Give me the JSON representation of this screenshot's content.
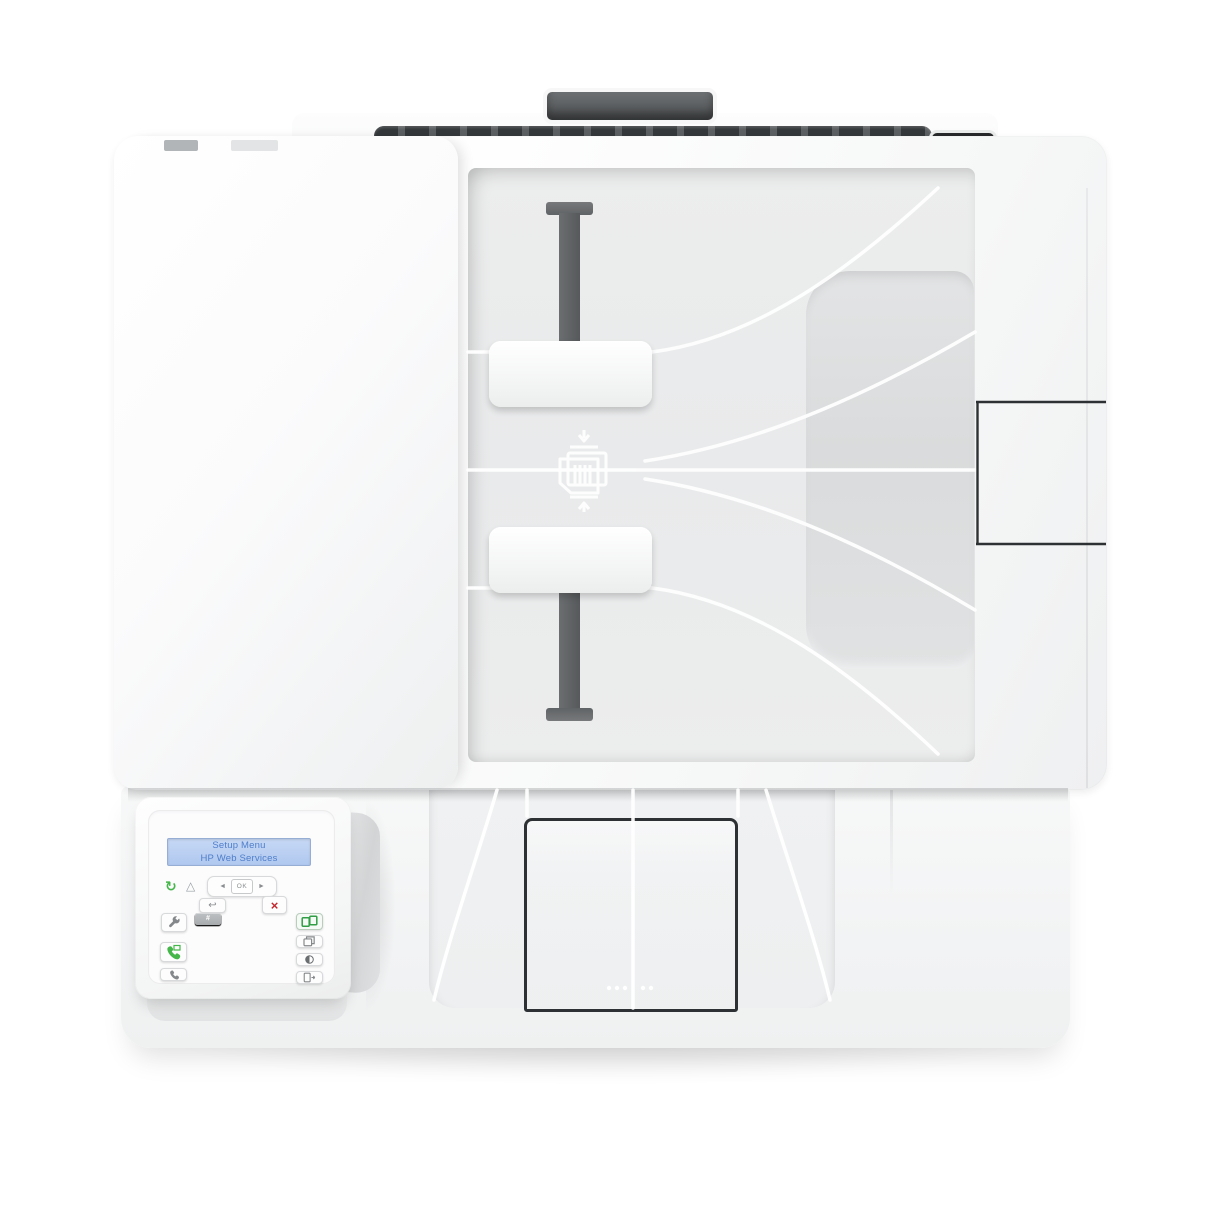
{
  "scene": {
    "description": "Top-down product photo of a white HP multifunction laser printer",
    "background_color": "#ffffff"
  },
  "printer": {
    "lcd": {
      "line1": "Setup Menu",
      "line2": "HP Web Services"
    },
    "status_icons": {
      "ready": "↻",
      "attention": "△"
    },
    "nav": {
      "left_arrow": "◄",
      "ok": "OK",
      "right_arrow": "►",
      "back": "↩",
      "cancel": "×"
    },
    "keypad": [
      {
        "digit": "1",
        "letters": ""
      },
      {
        "digit": "2",
        "letters": "ABC"
      },
      {
        "digit": "3",
        "letters": "DEF"
      },
      {
        "digit": "4",
        "letters": "GHI"
      },
      {
        "digit": "5",
        "letters": "JKL"
      },
      {
        "digit": "6",
        "letters": "MNO"
      },
      {
        "digit": "7",
        "letters": "PQRS"
      },
      {
        "digit": "8",
        "letters": "TUV"
      },
      {
        "digit": "9",
        "letters": "WXYZ"
      },
      {
        "digit": "*",
        "letters": "·@"
      },
      {
        "digit": "0",
        "letters": ""
      },
      {
        "digit": "#",
        "letters": ","
      }
    ],
    "function_keys": {
      "left_column": [
        "setup-wrench",
        "fax-start",
        "redial"
      ],
      "right_column": [
        "id-copy",
        "number-of-copies",
        "lighter-darker-contrast",
        "copy-options"
      ]
    },
    "colors": {
      "lcd_bg": "#b9cff2",
      "lcd_text": "#4e7ecb",
      "accent_green": "#45b649",
      "cancel_red": "#c4262d",
      "key_gray": "#b0b3b5",
      "trim_dark": "#3e4143",
      "tray_gray": "#eceded"
    }
  }
}
